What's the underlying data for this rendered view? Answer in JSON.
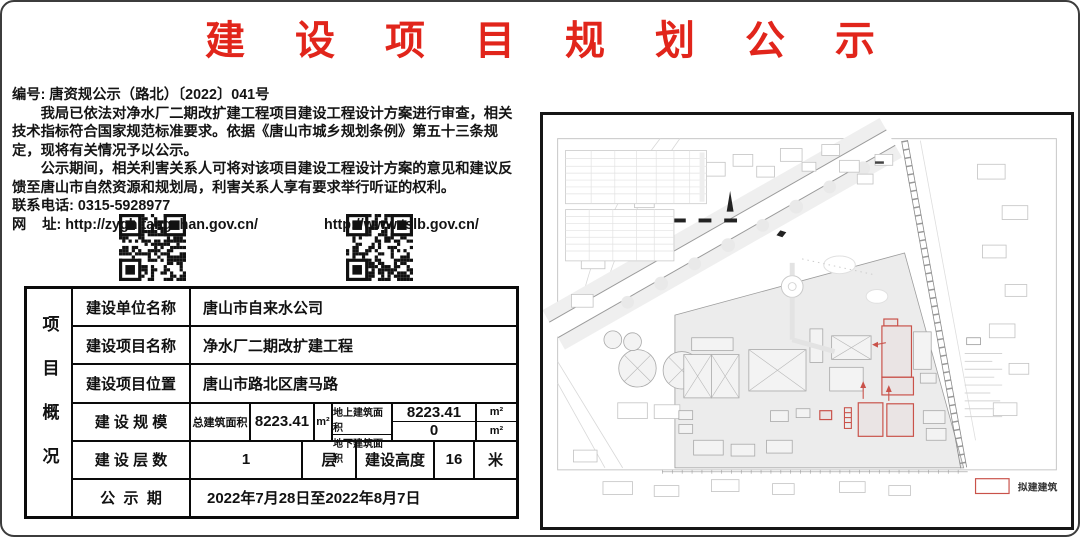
{
  "title": "建设项目规划公示",
  "notice": {
    "doc_number": "编号: 唐资规公示（路北）〔2022〕041号",
    "paragraph1": "我局已依法对净水厂二期改扩建工程项目建设工程设计方案进行审查，相关技术指标符合国家规范标准要求。依据《唐山市城乡规划条例》第五十三条规定，现将有关情况予以公示。",
    "paragraph2": "公示期间，相关利害关系人可将对该项目建设工程设计方案的意见和建议反馈至唐山市自然资源和规划局，利害关系人享有要求举行听证的权利。",
    "phone": "联系电话: 0315-5928977",
    "website_label": "网    址: ",
    "url_primary": "http://zygh.tangshan.gov.cn/",
    "url_secondary": "http://www.tslb.gov.cn/"
  },
  "project_table": {
    "side_header": "项目概况",
    "unit_row": {
      "label": "建设单位名称",
      "value": "唐山市自来水公司"
    },
    "name_row": {
      "label": "建设项目名称",
      "value": "净水厂二期改扩建工程"
    },
    "location_row": {
      "label": "建设项目位置",
      "value": "唐山市路北区唐马路"
    },
    "scale_row": {
      "label": "建 设 规 模",
      "total_label": "总建筑面积",
      "total_value": "8223.41",
      "total_unit": "m²",
      "above_label": "地上建筑面积",
      "above_value": "8223.41",
      "above_unit": "m²",
      "under_label": "地下建筑面积",
      "under_value": "0",
      "under_unit": "m²"
    },
    "floors_row": {
      "label": "建 设 层 数",
      "value": "1",
      "unit": "层",
      "height_label": "建设高度",
      "height_value": "16",
      "height_unit": "米"
    },
    "period_row": {
      "label": "公  示  期",
      "value": "2022年7月28日至2022年8月7日"
    }
  },
  "map": {
    "legend_proposed": "拟建建筑"
  },
  "colors": {
    "title_red": "#e1251b",
    "proposed_red": "#c9524a"
  }
}
